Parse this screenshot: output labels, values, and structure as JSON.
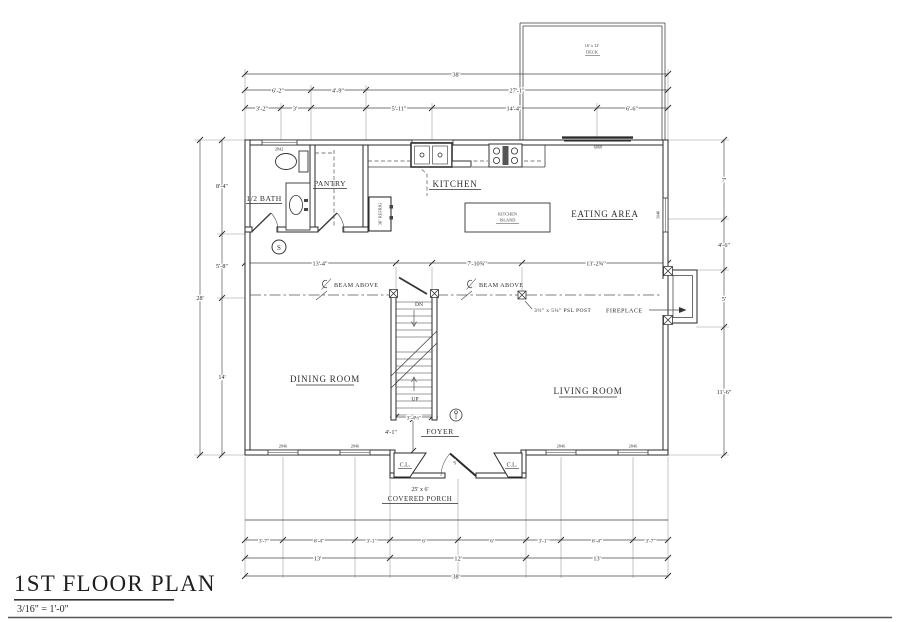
{
  "colors": {
    "paper": "#ffffff",
    "ink": "#2d2d2d",
    "wall": "#282828"
  },
  "title_block": {
    "title": "1ST FLOOR PLAN",
    "scale": "3/16\" = 1'-0\""
  },
  "rooms": {
    "half_bath": "1/2 BATH",
    "pantry": "PANTRY",
    "kitchen": "KITCHEN",
    "island_line1": "KITCHEN",
    "island_line2": "ISLAND",
    "eating_area": "EATING AREA",
    "dining_room": "DINING ROOM",
    "living_room": "LIVING ROOM",
    "foyer": "FOYER",
    "closet": "C.L.",
    "porch_size": "25' x 6'",
    "porch": "COVERED PORCH",
    "deck_size": "16' x 12'",
    "deck": "DECK"
  },
  "annotations": {
    "beam_above": "BEAM ABOVE",
    "psl_post": "3½\" x 5¼\" PSL POST",
    "fireplace": "FIREPLACE",
    "refrig": "36\" REFRIG",
    "dn": "DN",
    "up": "UP",
    "smoke": "S",
    "door_width": "3'"
  },
  "dims": {
    "top1": "38'",
    "top2": [
      "6'-2\"",
      "4'-9\"",
      "27'-1\""
    ],
    "top3": [
      "3'-2\"",
      "3'",
      "5'-11\"",
      "14'-4\"",
      "6'-6\""
    ],
    "left": [
      "8'-4\"",
      "5'-8\"",
      "14'"
    ],
    "left_overall": "28'",
    "right": [
      "7'",
      "4'-6\"",
      "5'",
      "11'-6\""
    ],
    "beam_row": [
      "13'-4\"",
      "7'-10¾\"",
      "13'-2¾\""
    ],
    "stair_width": "3'-4½\"",
    "foyer_depth": "4'-1\"",
    "bottom1": [
      "3'-7\"",
      "6'-4\"",
      "3'-1\"",
      "6'",
      "6'",
      "3'-1\"",
      "6'-4\"",
      "3'-7\""
    ],
    "bottom2": [
      "13'",
      "12'",
      "13'"
    ],
    "bottom3": "38'"
  },
  "window_labels": {
    "top_left": "2842",
    "top_sink": "3042",
    "slider": "6068",
    "right_wall": "3046",
    "bottom": [
      "2846",
      "2846",
      "2846",
      "2846"
    ]
  }
}
